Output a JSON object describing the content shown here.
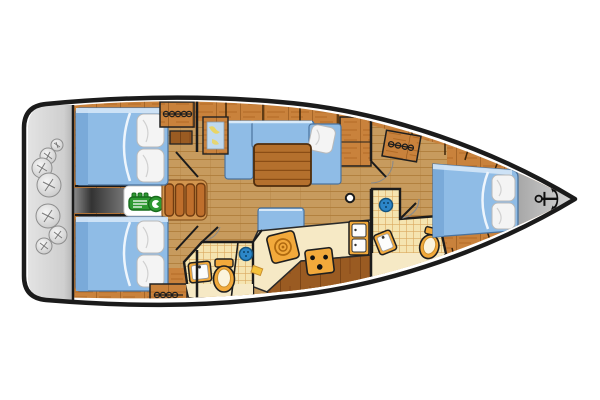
{
  "diagram": {
    "type": "sailing-yacht-interior-floor-plan",
    "view": "top-down",
    "orientation": "bow-right-stern-left",
    "anchor_glyph": "⚓"
  },
  "colors": {
    "background": "#ffffff",
    "hull_outline": "#1b1b1b",
    "deck_wood": "#c9823c",
    "floor_wood": "#c79b5e",
    "furniture_wood": "#b4702d",
    "cabinet_dark_wood": "#9a5b22",
    "upholstery_blue": "#8fbce6",
    "upholstery_shadow_blue": "#7aaad9",
    "upholstery_highlight": "#d8e9f8",
    "pillow_white": "#f4f4f4",
    "platform_gray": "#d2d2d2",
    "engine_bay_gray": "#3c3c3c",
    "engine_green": "#2e9932",
    "fixture_orange": "#f2a93b",
    "counter_cream": "#f6e9c5",
    "tile_beige": "#f5e4b0",
    "tile_grid": "#dba95f",
    "shower_blue": "#2c86c8",
    "chart_blue": "#bfd9ee",
    "chart_yellow": "#e9d565",
    "anchor_black": "#101010"
  },
  "legend": {
    "areas": [
      {
        "id": "stern-platform",
        "meaning": "Stern swim platform with fenders"
      },
      {
        "id": "aft-cabin-starboard",
        "meaning": "Aft double cabin (top) with bed and hanging locker"
      },
      {
        "id": "aft-cabin-port",
        "meaning": "Aft double cabin (bottom) with bed and hanging locker"
      },
      {
        "id": "engine-compartment",
        "meaning": "Engine compartment between aft cabins"
      },
      {
        "id": "companionway",
        "meaning": "Companionway entry steps"
      },
      {
        "id": "saloon",
        "meaning": "Saloon with L-shaped settee, table and bench"
      },
      {
        "id": "galley",
        "meaning": "Galley with sink, stove and fridge cabinet"
      },
      {
        "id": "head-aft",
        "meaning": "Aft bathroom with shower, sink and toilet"
      },
      {
        "id": "head-forward",
        "meaning": "Forward bathroom with shower, sink and toilet"
      },
      {
        "id": "forward-cabin",
        "meaning": "Forward double cabin"
      },
      {
        "id": "bow",
        "meaning": "Bow tip with anchor"
      }
    ],
    "fixtures": [
      {
        "icon": "anchor-icon",
        "meaning": "anchor at bow"
      },
      {
        "icon": "engine-icon",
        "meaning": "inboard engine"
      },
      {
        "icon": "fender-icon",
        "meaning": "round fenders stowed on platform"
      },
      {
        "icon": "hanger-icon",
        "meaning": "clothes hangers / hanging locker"
      },
      {
        "icon": "shower-icon",
        "meaning": "shower head"
      },
      {
        "icon": "toilet-icon",
        "meaning": "marine toilet"
      },
      {
        "icon": "sink-icon",
        "meaning": "wash basin"
      },
      {
        "icon": "stove-icon",
        "meaning": "stove with burners"
      },
      {
        "icon": "fridge-icon",
        "meaning": "fridge / locker doors"
      },
      {
        "icon": "mast-icon",
        "meaning": "mast post in saloon"
      },
      {
        "icon": "chart-icon",
        "meaning": "framed chart on bulkhead"
      },
      {
        "icon": "companionway-icon",
        "meaning": "steps down from cockpit"
      }
    ],
    "counts": {
      "double_beds": 3,
      "pillows": 7,
      "fenders": 7,
      "bathrooms": 2,
      "showers": 2,
      "hanging_lockers": 3
    }
  }
}
